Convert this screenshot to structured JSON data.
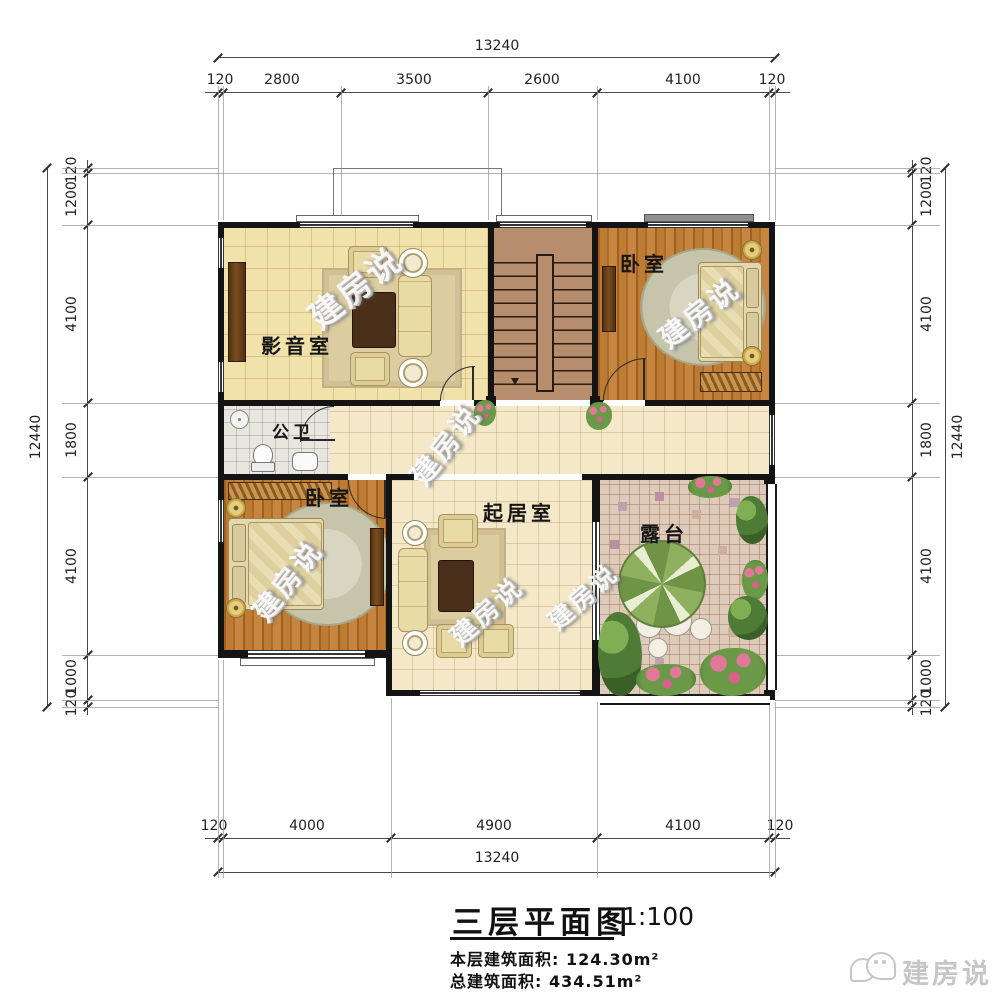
{
  "watermark_text": "建房说",
  "plan": {
    "rooms": {
      "media_room": "影音室",
      "bedroom_top_right": "卧室",
      "bathroom": "公卫",
      "bedroom_bottom_left": "卧室",
      "living_room": "起居室",
      "terrace": "露台"
    }
  },
  "dimensions": {
    "top": {
      "total": "13240",
      "segments": [
        "120",
        "2800",
        "3500",
        "2600",
        "4100",
        "120"
      ]
    },
    "bottom": {
      "total": "13240",
      "segments": [
        "120",
        "4000",
        "4900",
        "4100",
        "120"
      ]
    },
    "left": {
      "total": "12440",
      "segments": [
        "120",
        "1200",
        "4100",
        "1800",
        "4100",
        "1000",
        "120"
      ]
    },
    "right": {
      "total": "12440",
      "segments": [
        "120",
        "1200",
        "4100",
        "1800",
        "4100",
        "1000",
        "120"
      ]
    }
  },
  "title_block": {
    "title": "三层平面图",
    "scale": "1:100",
    "floor_area_label": "本层建筑面积:",
    "floor_area_value": "124.30m²",
    "total_area_label": "总建筑面积:",
    "total_area_value": "434.51m²"
  },
  "brand": {
    "name": "建房说"
  },
  "colors": {
    "wall": "#141414",
    "media_floor": "#f1e2ab",
    "wood_floor": "#b9762f",
    "tile_floor": "#f4e8c9",
    "bath_floor": "#e9e6df",
    "stair_floor": "#b78e6d",
    "terrace_floor": "#decab8",
    "dim_line": "#4a4a4a",
    "brand_gray": "#c6c6c6"
  }
}
